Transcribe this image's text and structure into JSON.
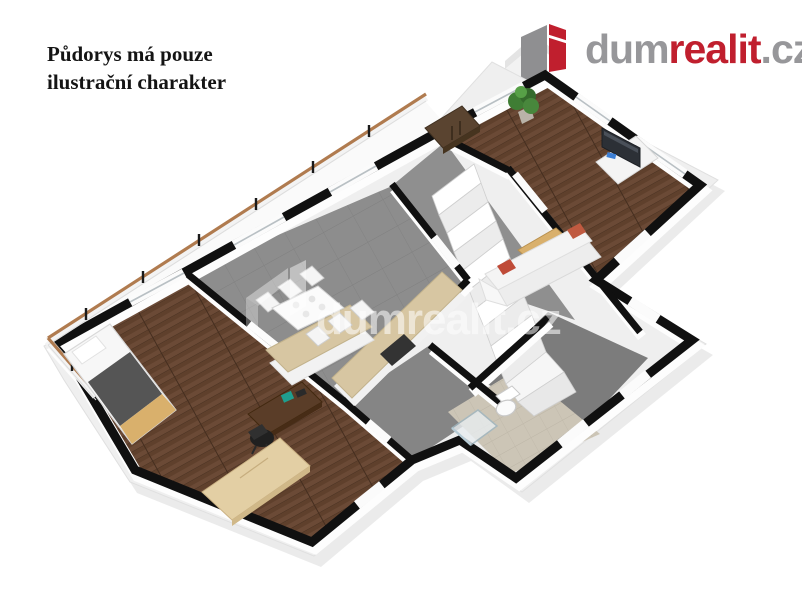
{
  "note": {
    "line1": "Půdorys má pouze",
    "line2": "ilustrační charakter"
  },
  "logo": {
    "part_gray1": "dum",
    "part_red": "realit",
    "part_gray2": ".cz",
    "gray": "#97979a",
    "red": "#c01f2e"
  },
  "watermark": {
    "text": "dumrealit.cz"
  },
  "colors": {
    "wall_black": "#101010",
    "wall_white": "#fdfdfd",
    "slab": "#efefef",
    "floor_wood": "#6b4a36",
    "floor_wood_dark": "#4a3222",
    "kitchen_gray": "#8d8d8d",
    "hall_gray": "#8f8f8f",
    "hallway_gray": "#858585",
    "roomb_gray": "#7c7c7c",
    "bath_beige": "#ccc5b6",
    "rail_wood": "#b07b4f",
    "counter_wood": "#d7c6a2",
    "light_wood": "#d9b06c",
    "sideboard_wood": "#e3cfa4",
    "sofa_white": "#f4f4f4",
    "pillow_red": "#bf4b38",
    "plant_green": "#3f7d34",
    "blanket_gray": "#555555",
    "desk_brown": "#5a3d28",
    "chair_black": "#202020",
    "tv_dark": "#2c3036",
    "tv_sticker_blue": "#3d7fd4",
    "wardrobe_brown": "#5a4430",
    "stair_white": "#ffffff"
  },
  "rooms": [
    {
      "id": "living-room",
      "floor": "dark-wood"
    },
    {
      "id": "kitchen-dining",
      "floor": "gray"
    },
    {
      "id": "stair-hall",
      "floor": "gray"
    },
    {
      "id": "bedroom-office",
      "floor": "dark-wood"
    },
    {
      "id": "hallway",
      "floor": "gray"
    },
    {
      "id": "utility-room",
      "floor": "gray"
    },
    {
      "id": "bathroom",
      "floor": "beige-tile"
    },
    {
      "id": "balcony",
      "floor": "white"
    }
  ]
}
